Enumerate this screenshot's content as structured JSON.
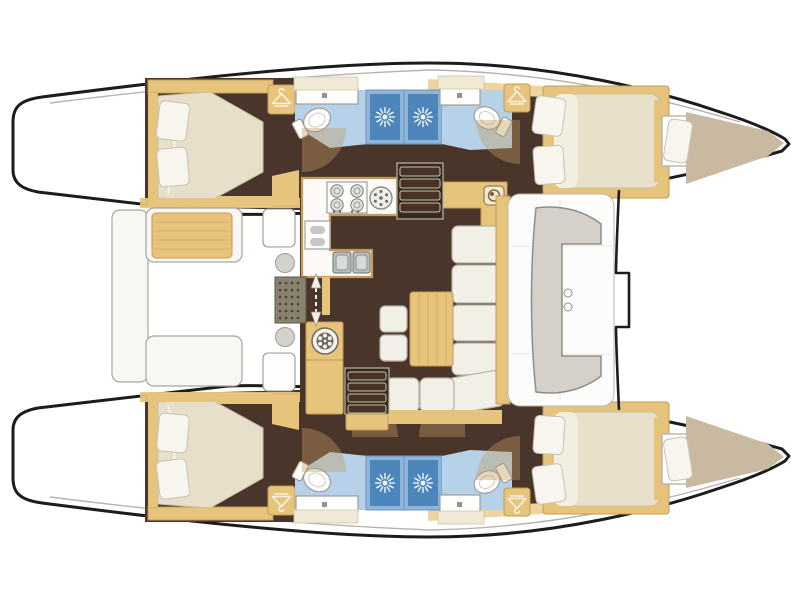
{
  "diagram": {
    "title": "Sailing catamaran interior floor plan, top-down view, bow to the right",
    "type": "floorplan",
    "vessel_layout": "4 cabins, 4 heads, saloon with galley, aft cockpit, forward cockpit, bow trampoline",
    "bow_direction": "right",
    "stern_direction": "left",
    "symmetry": "port and starboard hulls mirrored about horizontal centerline"
  },
  "hull_rooms": [
    {
      "name": "transom-swim-platform",
      "label": "Transom steps / swim platform"
    },
    {
      "name": "aft-cabin",
      "label": "Aft double cabin with island berth and pillows"
    },
    {
      "name": "aft-head",
      "label": "Aft head: washbasin, toilet, separate shower stall"
    },
    {
      "name": "forward-head",
      "label": "Forward head: shower stall, washbasin, toilet"
    },
    {
      "name": "forward-cabin",
      "label": "Forward double cabin with berth and pillows"
    },
    {
      "name": "forepeak",
      "label": "Forepeak berth in bow"
    }
  ],
  "center_rooms": [
    {
      "name": "aft-cockpit",
      "label": "Aft cockpit with table and wrap-around benches"
    },
    {
      "name": "saloon",
      "label": "Saloon: U-galley, L-shaped sofa, table, stools, nav station"
    },
    {
      "name": "forward-cockpit",
      "label": "Forward cockpit with C-shaped bench"
    },
    {
      "name": "trampoline",
      "label": "Bow trampoline area between hulls"
    }
  ],
  "fixtures": {
    "stove_burners": 4,
    "galley_sinks": 2,
    "shower_stalls": 4,
    "toilets": 4,
    "washbasins": 4,
    "wardrobes": 4,
    "companionway_stairs": 2,
    "cockpit_tables": 1,
    "saloon_tables": 1
  },
  "icons": [
    {
      "name": "shower-rose-icon",
      "meaning": "shower stall sunburst rose"
    },
    {
      "name": "hanger-icon",
      "meaning": "wardrobe / hanging locker"
    },
    {
      "name": "burner-icon",
      "meaning": "stove burner"
    },
    {
      "name": "fan-hatch-icon",
      "meaning": "round vent / washer hatch"
    },
    {
      "name": "entry-arrow-icon",
      "meaning": "companionway entry direction"
    }
  ],
  "colors": {
    "outline_black": "#1c1c1c",
    "outline_grey": "#b6b4ae",
    "floor_dark": "#4a352a",
    "wood": "#e6c47c",
    "wood_dark": "#c49a55",
    "wood_light": "#ecd49c",
    "wood_grain": "#d4ad5f",
    "cream_cab": "#f0e9d6",
    "bed": "#e7dfca",
    "pillow": "#f7f5ee",
    "tan_berth": "#c9b9a0",
    "bath_floor": "#b7d2e8",
    "shower_frame": "#8fb6da",
    "shower": "#4c86bb",
    "bench_white": "#f8f7f3",
    "bench_grey": "#d5d1ca",
    "cushion": "#f2efe7",
    "stroke_grey": "#9a978f",
    "arc_tan": "#c19a63",
    "mat": "#8a8270",
    "mat_dot": "#474033",
    "steel": "#b9beba"
  }
}
